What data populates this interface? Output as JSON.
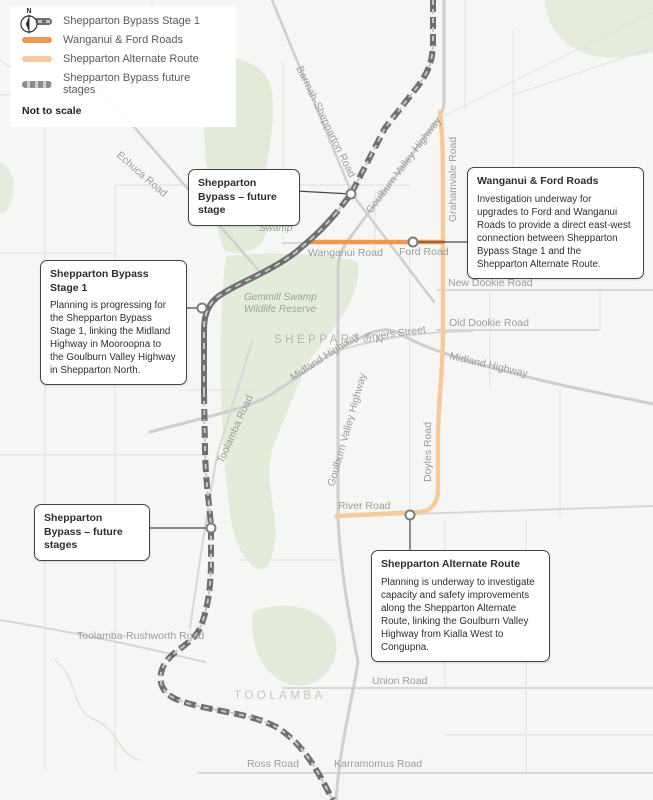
{
  "legend": {
    "items": [
      {
        "id": "stage1",
        "label": "Shepparton Bypass Stage 1"
      },
      {
        "id": "wanganui",
        "label": "Wanganui & Ford Roads"
      },
      {
        "id": "alternate",
        "label": "Shepparton Alternate Route"
      },
      {
        "id": "future",
        "label": "Shepparton Bypass future stages"
      }
    ],
    "compass_letter": "N",
    "scale_note": "Not to scale"
  },
  "callouts": [
    {
      "id": "future-stage",
      "title": "Shepparton Bypass – future stage",
      "body": ""
    },
    {
      "id": "stage1",
      "title": "Shepparton Bypass Stage 1",
      "body": "Planning is progressing for the Shepparton Bypass Stage 1, linking the Midland Highway in Mooroopna to the Goulburn Valley Highway in Shepparton North."
    },
    {
      "id": "future-stages",
      "title": "Shepparton Bypass – future stages",
      "body": ""
    },
    {
      "id": "wanganui-ford",
      "title": "Wanganui & Ford Roads",
      "body": "Investigation underway for upgrades to Ford and Wanganui Roads to provide a direct east-west connection between Shepparton Bypass Stage 1 and the Shepparton Alternate Route."
    },
    {
      "id": "alternate-route",
      "title": "Shepparton Alternate Route",
      "body": "Planning is underway to investigate capacity and safety improvements along the Shepparton Alternate Route, linking the Goulburn Valley Highway from Kialla West to Congupna."
    }
  ],
  "map_labels": {
    "roads": [
      "Barmah-Shepparton Road",
      "Echuca Road",
      "Goulburn Valley Highway",
      "Grahamvale Road",
      "Wanganui Road",
      "Ford Road",
      "New Dookie Road",
      "Old Dookie Road",
      "Fryers Street",
      "Midland Highway",
      "Midland Highway",
      "Goulburn Valley Highway",
      "Doyles Road",
      "Toolamba Road",
      "River Road",
      "Toolamba-Rushworth Road",
      "Union Road",
      "Ross Road",
      "Karramomus Road"
    ],
    "places": [
      "SHEPPARTON",
      "TOOLAMBA"
    ],
    "areas": [
      "Reedy",
      "Swamp",
      "Gemmill Swamp",
      "Wildlife Reserve"
    ]
  },
  "colors": {
    "stage1_route": "#6f6f6f",
    "future_route": "#6f6f6f",
    "wanganui_ford_route": "#ec9a50",
    "alternate_route": "#f4cb9e",
    "map_background": "#f6f6f4",
    "green_area": "#e5ecdd",
    "road_gray": "#cfcfcb",
    "label_gray": "#9c9c99"
  }
}
